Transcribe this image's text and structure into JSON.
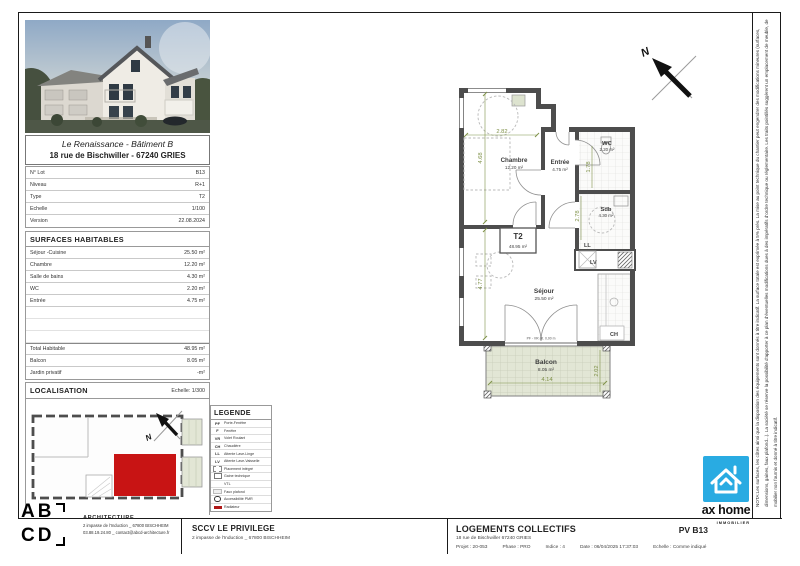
{
  "project_header": {
    "title": "Le Renaissance - Bâtiment B",
    "address": "18 rue de Bischwiller - 67240 GRIES"
  },
  "lot_table": {
    "rows": [
      {
        "label": "N° Lot",
        "value": "B13"
      },
      {
        "label": "Niveau",
        "value": "R+1"
      },
      {
        "label": "Type",
        "value": "T2"
      },
      {
        "label": "Echelle",
        "value": "1/100"
      },
      {
        "label": "Version",
        "value": "22.08.2024"
      }
    ]
  },
  "surfaces": {
    "title": "SURFACES HABITABLES",
    "rows": [
      {
        "label": "Séjour -Cuisine",
        "value": "25.50 m²"
      },
      {
        "label": "Chambre",
        "value": "12.20 m²"
      },
      {
        "label": "Salle de bains",
        "value": "4.30 m²"
      },
      {
        "label": "WC",
        "value": "2.20 m²"
      },
      {
        "label": "Entrée",
        "value": "4.75 m²"
      }
    ],
    "totals": [
      {
        "label": "Total Habitable",
        "value": "48.95 m²"
      },
      {
        "label": "Balcon",
        "value": "8.05 m²"
      },
      {
        "label": "Jardin privatif",
        "value": "-m²"
      }
    ]
  },
  "localisation": {
    "title": "LOCALISATION",
    "scale": "Echelle: 1/300"
  },
  "legend": {
    "title": "LEGENDE",
    "items": [
      {
        "code": "PF",
        "label": "Porte-Fenêtre"
      },
      {
        "code": "F",
        "label": "Fenêtre"
      },
      {
        "code": "VR",
        "label": "Volet Roulant"
      },
      {
        "code": "CH",
        "label": "Chaudière"
      },
      {
        "code": "LL",
        "label": "Attente Lave-Linge"
      },
      {
        "code": "LV",
        "label": "Attente Lave-Vaisselle"
      },
      {
        "code": "",
        "label": "Placement intégré"
      },
      {
        "code": "",
        "label": "Gaine technique"
      },
      {
        "code": "",
        "label": "VTL"
      },
      {
        "code": "",
        "label": "Faux plafond"
      },
      {
        "code": "",
        "label": "Accessibilité PMR"
      },
      {
        "code": "",
        "label": "Radiateur"
      }
    ]
  },
  "plan": {
    "north_label": "N",
    "unit": {
      "type": "T2",
      "area": "48.95 m²"
    },
    "rooms": {
      "chambre": {
        "name": "Chambre",
        "area": "12.20 m²"
      },
      "entree": {
        "name": "Entrée",
        "area": "4.75 m²"
      },
      "wc": {
        "name": "WC",
        "area": "2.20 m²"
      },
      "sdb": {
        "name": "Sdb",
        "area": "4.30 m²"
      },
      "sejour": {
        "name": "Séjour",
        "area": "25.50 m²"
      },
      "balcon": {
        "name": "Balcon",
        "area": "8.05 m²"
      }
    },
    "appliances": {
      "ll": "LL",
      "lv": "LV",
      "ch": "CH"
    },
    "dims": {
      "top": "2.82",
      "chambre_v": "4.68",
      "entree_v": "1.78",
      "sdb_v": "2.78",
      "sejour_v": "4.77",
      "balcon_w": "4.14",
      "balcon_h": "2.02"
    },
    "door_note": "PF - VR alt. 0,00 m"
  },
  "nota": {
    "text": "NOTA:Les surfaces, les côtes ainsi que la disposition des équipements sont donnés à titre indicatif. La surface totale est exprimée à 5% près. La mise au point technique du chantier peut engendrer des modifications mineures (surfaces, dimensions, gaines, faux plafond...). La société se réserve la possibilité d'apporter à ce plan d'éventuelles modifications dues à des impératifs d'ordre technique ou réglementaire. Les traits pointillés suggèrent un emplacement de meuble, de mobilier non fournis et donné à titre indicatif."
  },
  "title_block": {
    "architect": {
      "letters_row1": "AB",
      "letters_row2": "CD",
      "name": "ARCHITECTURE",
      "address": "2 impasse de l'Induction _ 67800 BISCHHEIM",
      "contact": "03.88.19.24.80 _ contact@abcd-architecture.fr"
    },
    "client": {
      "name": "SCCV LE PRIVILEGE",
      "address": "2 impasse de l'Induction _ 67800 BISCHHEIM"
    },
    "project": {
      "title": "LOGEMENTS COLLECTIFS",
      "address": "18 rue de Bischwiller 67240 GRIES",
      "meta": [
        "Projet : 20-053",
        "Phase : PRO",
        "Indice : 4",
        "Date : 06/04/2025 17:37:03",
        "Echelle : Comme indiqué"
      ]
    },
    "sheet_ref": "PV B13",
    "brand": {
      "name": "ax home",
      "sub": "IMMOBILIER"
    }
  },
  "colors": {
    "accent_red": "#c81414",
    "wall": "#4d4d4d",
    "dim_green": "#7f9148",
    "balcony": "#e2e6d5",
    "brand_blue": "#29abe2"
  }
}
